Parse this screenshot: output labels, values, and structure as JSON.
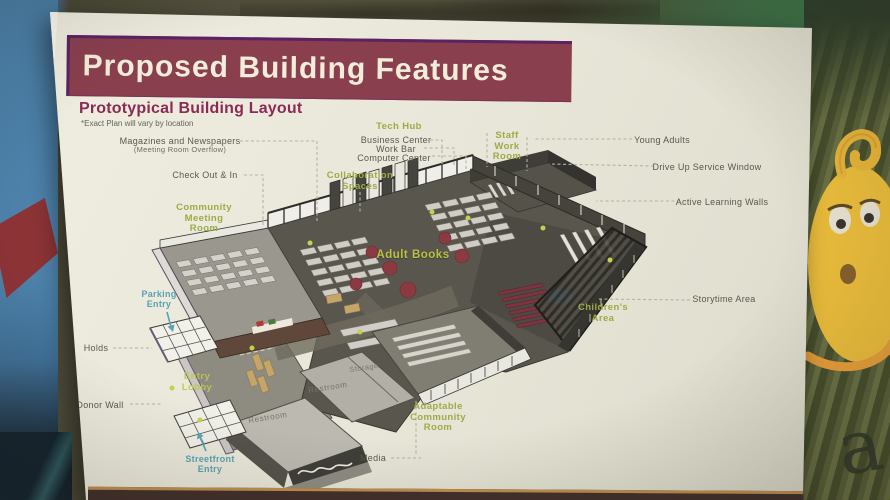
{
  "header": {
    "title": "Proposed Building Features"
  },
  "subheader": {
    "title": "Prototypical Building Layout",
    "note": "*Exact Plan will vary by location"
  },
  "plan_labels": {
    "magazines": [
      "Magazines and Newspapers",
      "(Meeting Room Overflow)"
    ],
    "check_out": "Check Out & In",
    "tech_hub": "Tech Hub",
    "business_center": "Business Center",
    "work_bar": "Work Bar",
    "computer_center": "Computer Center",
    "collaboration": [
      "Collaboration",
      "Spaces"
    ],
    "community_meeting": [
      "Community",
      "Meeting",
      "Room"
    ],
    "staff_work": [
      "Staff",
      "Work",
      "Room"
    ],
    "young_adults": "Young Adults",
    "drive_up": "Drive Up Service Window",
    "active_learning": "Active Learning Walls",
    "storytime": "Storytime Area",
    "childrens": [
      "Children's",
      "Area"
    ],
    "adult_books": "Adult Books",
    "parking": [
      "Parking",
      "Entry"
    ],
    "holds": "Holds",
    "entry_lobby": [
      "Entry",
      "Lobby"
    ],
    "donor_wall": "Donor Wall",
    "streetfront": [
      "Streetfront",
      "Entry"
    ],
    "restroom_upper": "Restroom",
    "restroom_lower": "Restroom",
    "storage": "Storage",
    "media": "Media",
    "adaptable": [
      "Adaptable",
      "Community",
      "Room"
    ]
  },
  "colors": {
    "banner": "#8a3f4e",
    "banner_border": "#5b2264",
    "banner_text": "#f2edda",
    "heading": "#8a2a55",
    "label_green": "#9dab46",
    "label_teal": "#57a3b4",
    "label_gray": "#57584f",
    "poster": "#e9e7da"
  }
}
